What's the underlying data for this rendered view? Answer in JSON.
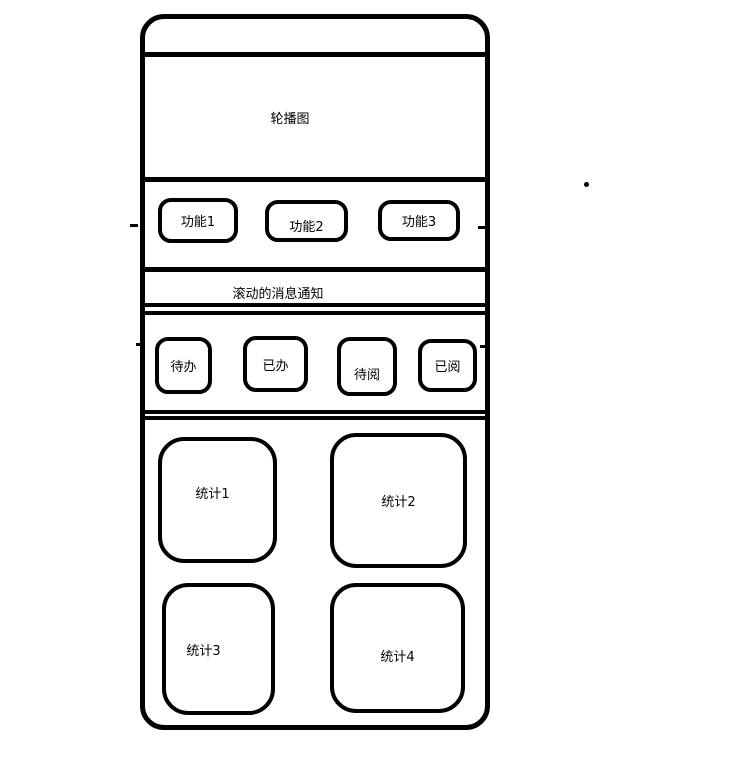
{
  "colors": {
    "line": "#000000",
    "background": "#ffffff",
    "text": "#000000"
  },
  "phone": {
    "carousel": {
      "label": "轮播图"
    },
    "functions": [
      {
        "label": "功能1"
      },
      {
        "label": "功能2"
      },
      {
        "label": "功能3"
      }
    ],
    "notification": {
      "label": "滚动的消息通知"
    },
    "tasks": [
      {
        "label": "待办"
      },
      {
        "label": "已办"
      },
      {
        "label": "待阅"
      },
      {
        "label": "已阅"
      }
    ],
    "stats": [
      {
        "label": "统计1"
      },
      {
        "label": "统计2"
      },
      {
        "label": "统计3"
      },
      {
        "label": "统计4"
      }
    ]
  }
}
